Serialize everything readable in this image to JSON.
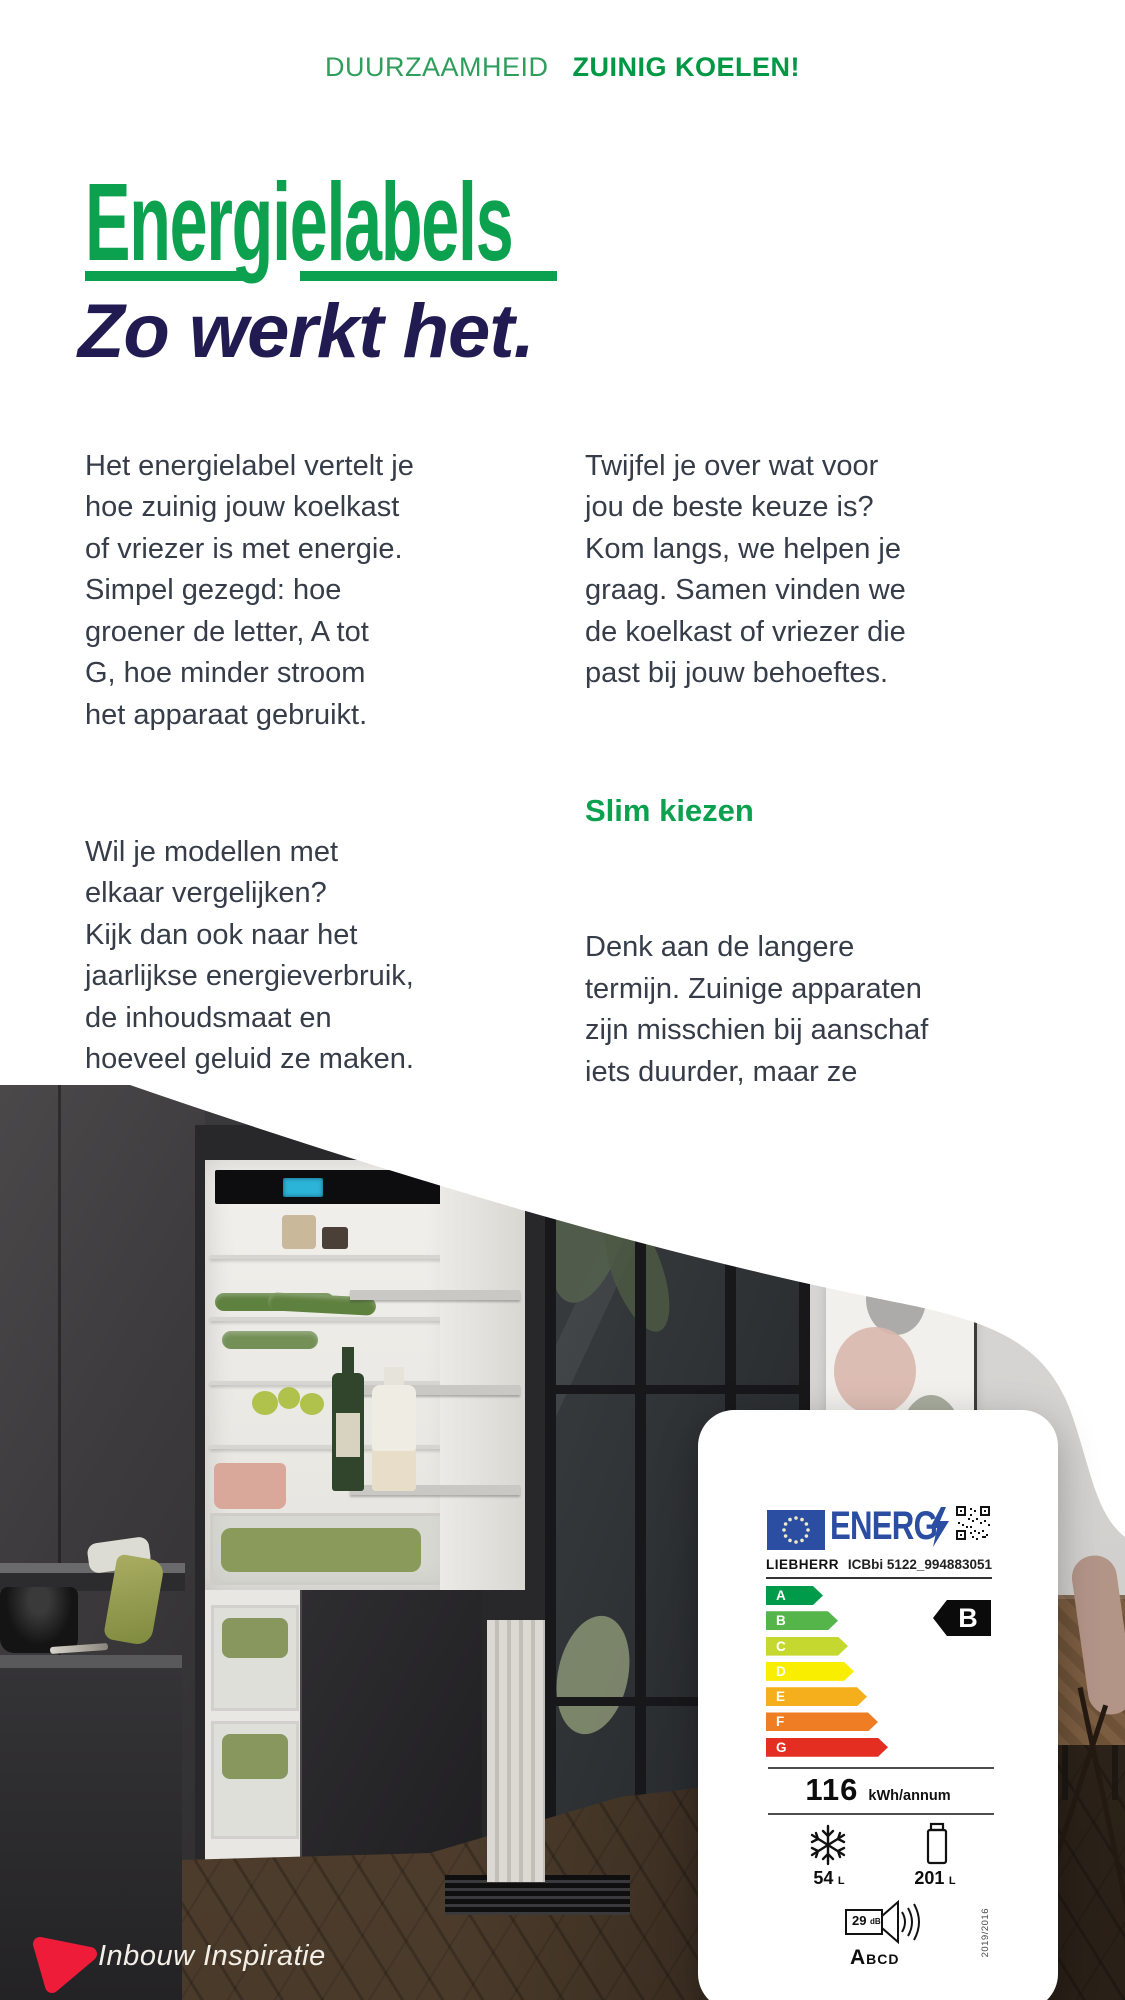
{
  "header": {
    "eyebrow_regular": "DUURZAAMHEID",
    "eyebrow_bold": "ZUINIG KOELEN!"
  },
  "hero": {
    "title": "Energielabels",
    "subtitle": "Zo werkt het."
  },
  "intro": {
    "left_para1": "Het energielabel vertelt je\nhoe zuinig jouw koelkast\nof vriezer is met energie.\nSimpel gezegd: hoe\ngroener de letter, A tot\nG, hoe minder stroom\nhet apparaat gebruikt.",
    "left_para2": "Wil je modellen met\nelkaar vergelijken?\nKijk dan ook naar het\njaarlijkse energieverbruik,\nde inhoudsmaat en\nhoeveel geluid ze maken.\nZo weet je precies\nwat je in huis haalt!",
    "right_para1": "Twijfel je over wat voor\njou de beste keuze is?\nKom langs, we helpen je\ngraag. Samen vinden we\nde koelkast of vriezer die\npast bij jouw behoeftes.",
    "right_heading": "Slim kiezen",
    "right_para2": "Denk aan de langere\ntermijn. Zuinige apparaten\nzijn misschien bij aanschaf\niets duurder, maar ze\ngebruiken veel minder\nenergie. Dat merk je\nin je portemonnee!"
  },
  "energy_label": {
    "logo_text": "ENERG",
    "brand": "LIEBHERR",
    "model": "ICBbi 5122_994883051",
    "rating": "B",
    "classes": [
      {
        "letter": "A",
        "color": "#009b4a",
        "width": 57
      },
      {
        "letter": "B",
        "color": "#55b44a",
        "width": 72
      },
      {
        "letter": "C",
        "color": "#c5d830",
        "width": 82
      },
      {
        "letter": "D",
        "color": "#f9ed00",
        "width": 88
      },
      {
        "letter": "E",
        "color": "#f5af1d",
        "width": 101
      },
      {
        "letter": "F",
        "color": "#ee7d23",
        "width": 112
      },
      {
        "letter": "G",
        "color": "#e52e22",
        "width": 122
      }
    ],
    "consumption_value": "116",
    "consumption_unit": "kWh/annum",
    "freezer_value": "54",
    "freezer_unit": "L",
    "fridge_value": "201",
    "fridge_unit": "L",
    "noise_value": "29",
    "noise_unit": "dB",
    "noise_scale_first": "A",
    "noise_scale_rest": "BCD",
    "regulation": "2019/2016",
    "accent_blue": "#2b4ea2"
  },
  "footer": {
    "brand": "Inbouw Inspiratie",
    "logo_color": "#ee1c38"
  },
  "colors": {
    "green": "#0ca14e",
    "green_dark": "#009845",
    "navy": "#221b52",
    "body_text": "#363d49",
    "card_background": "#ffffff"
  }
}
